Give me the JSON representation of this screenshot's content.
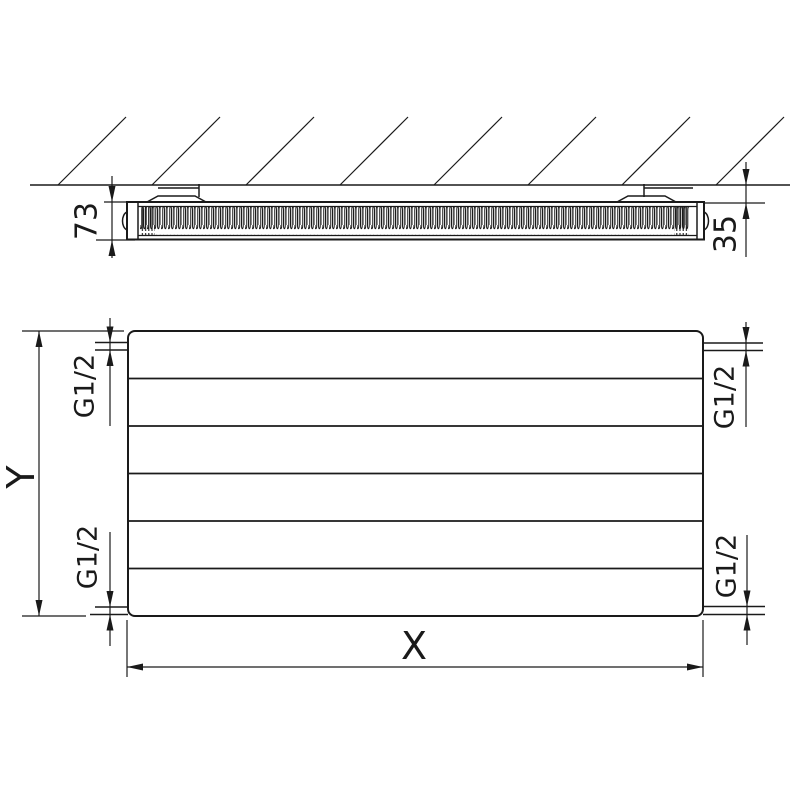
{
  "colors": {
    "line": "#1a1a1a",
    "background": "#ffffff"
  },
  "top_view": {
    "depth_label": "73",
    "wall_gap_label": "35"
  },
  "front_view": {
    "height_label": "Y",
    "width_label": "X",
    "connections": {
      "top_left": "G1/2",
      "top_right": "G1/2",
      "bottom_left": "G1/2",
      "bottom_right": "G1/2"
    }
  }
}
